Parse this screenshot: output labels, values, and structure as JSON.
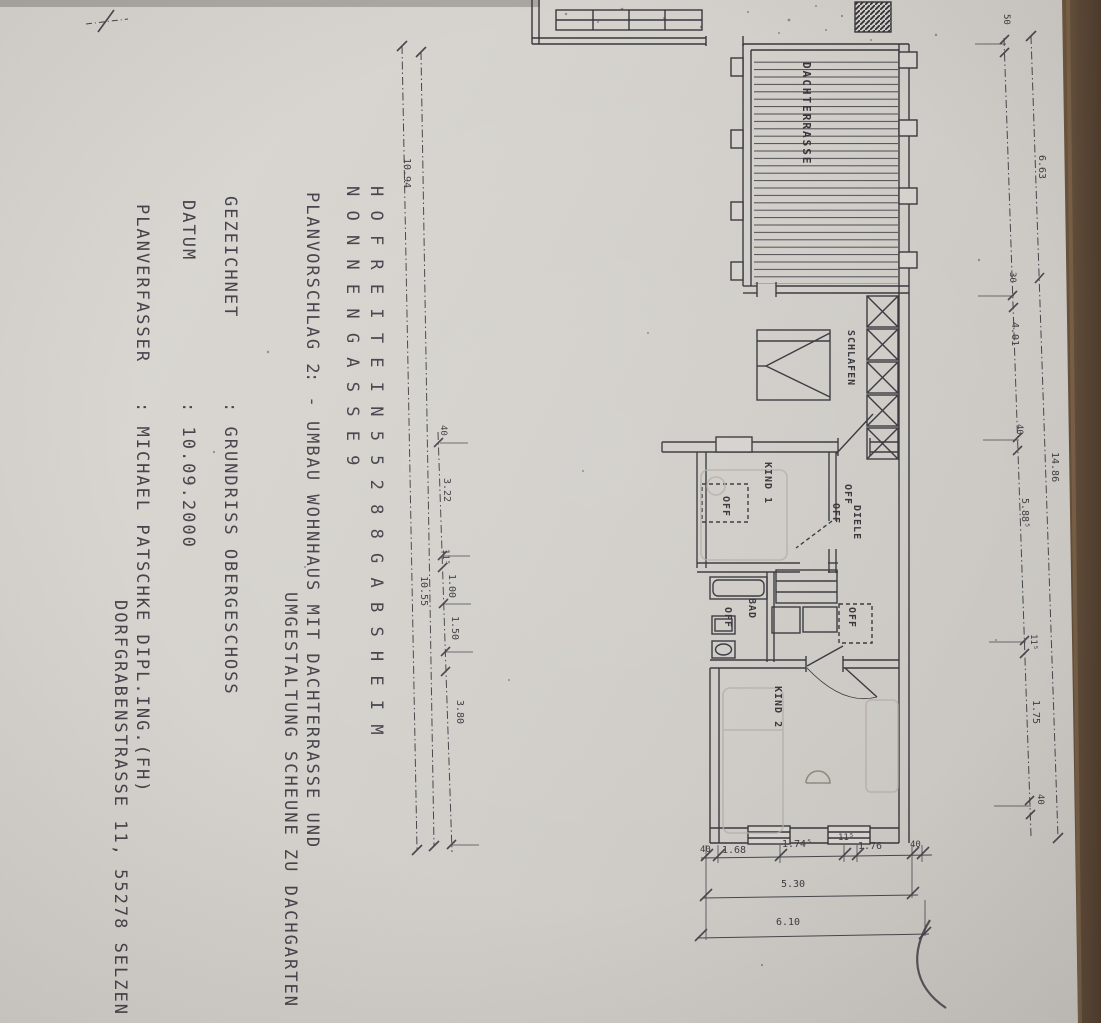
{
  "titleblock": {
    "line1": "H O F R E I T E   I N   5 5 2 8 8   G A B S H E I M",
    "line2": "N O N N E N G A S S E   9",
    "planvorschlag_label": "PLANVORSCHLAG 2",
    "planvorschlag_value1": ":  - UMBAU WOHNHAUS MIT DACHTERRASSE UND",
    "planvorschlag_value2": "UMGESTALTUNG SCHEUNE ZU DACHGARTEN",
    "gezeichnet_label": "GEZEICHNET",
    "gezeichnet_value": ":  GRUNDRISS OBERGESCHOSS",
    "datum_label": "DATUM",
    "datum_value": ":  10.09.2000",
    "planverfasser_label": "PLANVERFASSER",
    "planverfasser_value1": ":  MICHAEL PATSCHKE DIPL.ING.(FH)",
    "planverfasser_value2": "DORFGRABENSTRASSE 11, 55278 SELZEN"
  },
  "rooms": {
    "dachterrasse": "DACHTERRASSE",
    "schlafen": "SCHLAFEN",
    "kind1": "KIND 1",
    "diele": "DIELE",
    "bad": "BAD",
    "kind2": "KIND 2",
    "off": "OFF"
  },
  "dims": {
    "left_total": "10.94",
    "left_partial": "10.55",
    "left_chain": [
      "40",
      "3.22",
      "11⁵",
      "1.00",
      "1.50",
      "3.80"
    ],
    "right_span_top": "6.63",
    "right_total": "14.86",
    "right_chain": [
      "50",
      "30",
      "4.01",
      "40",
      "5.88⁵",
      "11⁵",
      "1.75",
      "40"
    ],
    "bottom_chain": [
      "40",
      "1.68",
      "1.74⁵",
      "11⁵",
      "1.76",
      "40"
    ],
    "bottom_width": "5.30",
    "bottom_total": "6.10"
  },
  "colors": {
    "paper": "#d5d2cd",
    "ink": "#37373d",
    "dimension": "#46464c",
    "pencil": "#b3aea6",
    "wood_edge": "#5d4937"
  }
}
